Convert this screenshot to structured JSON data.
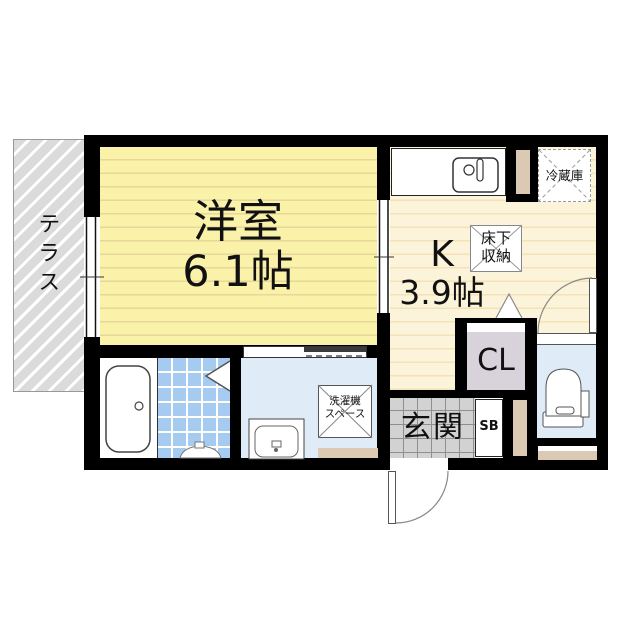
{
  "floorplan": {
    "terrace": {
      "label": "テラス"
    },
    "main_room": {
      "name": "洋室",
      "area": "6.1帖"
    },
    "kitchen": {
      "name": "K",
      "area": "3.9帖"
    },
    "underfloor_storage": {
      "line1": "床下",
      "line2": "収納"
    },
    "refrigerator": {
      "label": "冷蔵庫"
    },
    "closet": {
      "label": "CL"
    },
    "entrance": {
      "label": "玄関"
    },
    "shoe_box": {
      "label": "SB"
    },
    "washer_space": {
      "line1": "洗濯機",
      "line2": "スペース"
    },
    "colors": {
      "wall": "#000000",
      "main_room_floor": "#FAF2A9",
      "kitchen_floor": "#FCF4DA",
      "bath_tile": "#A6CBF1",
      "sanitary_floor": "#DFEBF7",
      "entrance_floor": "#D2D2D2",
      "terrace": "#DBDBDB",
      "closet_fill": "#D8D2DB",
      "accent_beige": "#DBC9B3"
    }
  }
}
